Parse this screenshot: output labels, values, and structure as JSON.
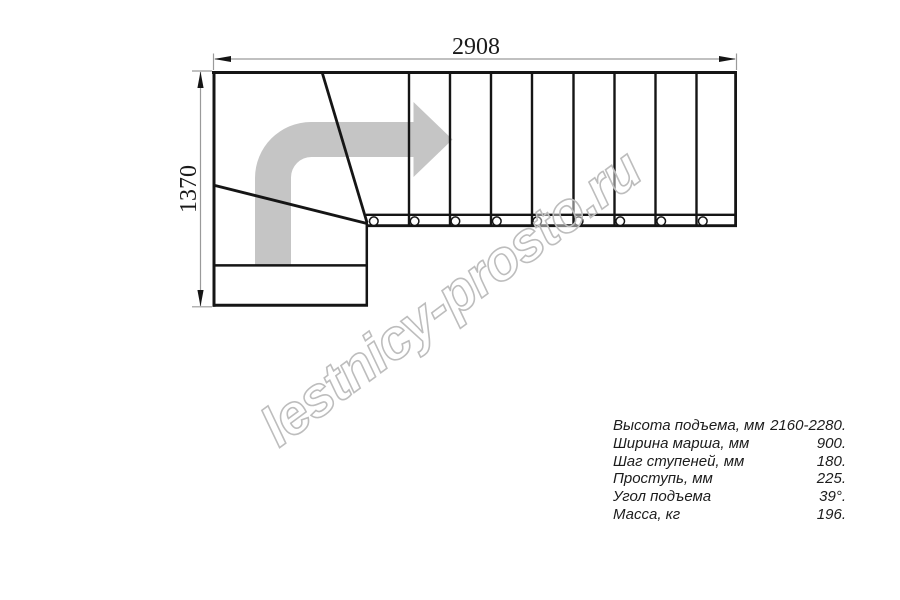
{
  "diagram": {
    "dimensions": {
      "width_mm": "2908",
      "height_mm": "1370"
    },
    "watermark": "lestnicy-prosto.ru",
    "straight_tread_count": 9,
    "colors": {
      "outline": "#151515",
      "dimension_line": "#9a9a9a",
      "direction_arrow": "#c5c5c5",
      "watermark_outline": "#bdbdbd",
      "background": "#ffffff"
    }
  },
  "specs": {
    "rows": [
      {
        "label": "Высота подъема, мм",
        "value": "2160-2280."
      },
      {
        "label": "Ширина марша, мм",
        "value": "900."
      },
      {
        "label": "Шаг ступеней, мм",
        "value": "180."
      },
      {
        "label": "Проступь, мм",
        "value": "225."
      },
      {
        "label": "Угол подъема",
        "value": "39°."
      },
      {
        "label": "Масса, кг",
        "value": "196."
      }
    ]
  }
}
